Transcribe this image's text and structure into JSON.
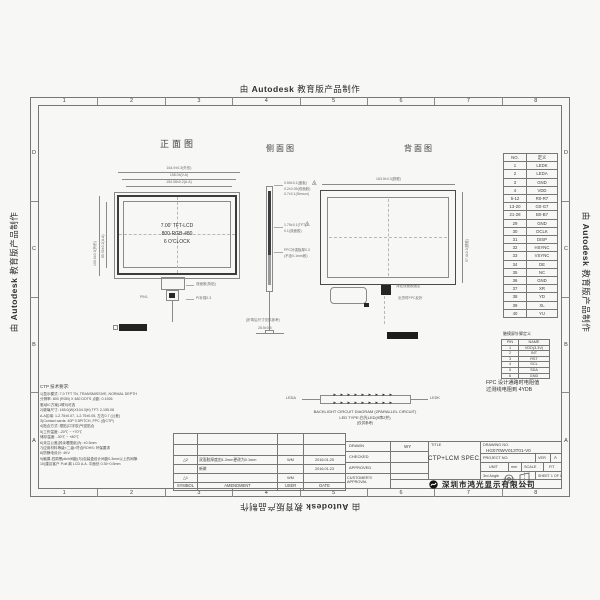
{
  "watermark": {
    "prefix": "由",
    "brand": "Autodesk",
    "suffix": "教育版产品制作"
  },
  "frame": {
    "zone_numbers": [
      "1",
      "2",
      "3",
      "4",
      "5",
      "6",
      "7",
      "8"
    ],
    "zone_letters": [
      "D",
      "C",
      "B",
      "A"
    ]
  },
  "front_view": {
    "title": "正面图",
    "center_line1": "7.00' TFT-LCD",
    "center_line2": "800-RGB-480",
    "center_line3": "6 O'CLOCK",
    "dim_top1": "164.9±0.3(外形)",
    "dim_top2": "158.04(V.A)",
    "dim_top3": "154.08±0.2(A.A)",
    "dim_left1": "100.0±0.3(外形)",
    "dim_left2": "85.92±0.2(A.A)",
    "note_pin": "PIN1",
    "note_right1": "双面胶(背贴)",
    "note_right2": "PI补强0.3"
  },
  "side_view": {
    "title": "侧面图",
    "ann_top1": "0.55±0.1(盖板)",
    "ann_top2": "0.2±0.05(双面胶)",
    "ann_top3": "0.7±0.1(Sensor)",
    "tri_top": "2",
    "ann_mid1": "1.75±0.1(TFT)",
    "ann_mid2": "0.1(双面胶)",
    "tri_mid": "1",
    "ann_low1": "FPC补强板厚0.3",
    "ann_low2": "(不含0.1mm胶)",
    "ann_bottom": "(折弯后尺寸仅供参考)",
    "dim_bottom": "28.5±0.5"
  },
  "back_view": {
    "title": "背面图",
    "dim_top": "163.9±0.3(铁框)",
    "dim_right": "97.4±0.3(铁框)",
    "note1": "背贴双面胶固定",
    "note2": "出货时FPC反折"
  },
  "pin_table": {
    "headers": [
      "NO.",
      "定义"
    ],
    "rows": [
      [
        "1",
        "LEDK"
      ],
      [
        "2",
        "LEDA"
      ],
      [
        "3",
        "GND"
      ],
      [
        "4",
        "VDD"
      ],
      [
        "5-12",
        "R0-R7"
      ],
      [
        "13-20",
        "G0-G7"
      ],
      [
        "21-28",
        "B0-B7"
      ],
      [
        "29",
        "GND"
      ],
      [
        "30",
        "DCLK"
      ],
      [
        "31",
        "DISP"
      ],
      [
        "32",
        "HSYNC"
      ],
      [
        "33",
        "VSYNC"
      ],
      [
        "34",
        "DE"
      ],
      [
        "35",
        "NC"
      ],
      [
        "36",
        "GND"
      ],
      [
        "37",
        "XR"
      ],
      [
        "38",
        "YD"
      ],
      [
        "39",
        "XL"
      ],
      [
        "40",
        "YU"
      ]
    ]
  },
  "ctp_table": {
    "title": "触摸屏针脚定义",
    "headers": [
      "PIN",
      "NAME"
    ],
    "rows": [
      [
        "1",
        "VDD(3.3V)"
      ],
      [
        "2",
        "INT"
      ],
      [
        "3",
        "RST"
      ],
      [
        "4",
        "SCL"
      ],
      [
        "5",
        "SDA"
      ],
      [
        "6",
        "GND"
      ]
    ]
  },
  "fpc_note": {
    "line1": "FPC 设计通路时电阻值",
    "line2": "过测线电阻到 4YDB"
  },
  "backlight": {
    "led_row": "▸▸▸▸▸▸▸▸▸",
    "label_left": "LEDA",
    "label_right": "LEDK",
    "caption1": "BACKLIGHT CIRCUIT DIAGRAM (2PARALLEL CIRCUIT)",
    "caption2": "LED TYPE:白光LED(9串2并)",
    "caption3": "(仅供参考)"
  },
  "notes": {
    "title": "CTP 技术要求:",
    "lines": [
      "1)显示模式: 7.0 TFT TN, TRANSMISSIVE, NORMAL DEPTH",
      "   分辨率: 800 (RGB) X 480 DOTS 点距: 0.1926",
      "   驱动IC方案(1联5)可选",
      "2)玻璃尺寸: 165.0(W)X104.3(H) TFT: 2-155.08",
      "   A.A区域: 1-2.75±0.07, 1-2.75±0.05, 左右0.7 (公差)",
      "3)Contact cards: 40P 0.5PITCH, FPC (含CTP)",
      "4)贴合方式: 框贴(口字胶)气密贴合",
      "5)工作温度: -20℃ ~ +70℃",
      "   储存温度: -30℃ ~ +80℃",
      "6)未注公差(其余看图纸)为: ±0.3mm",
      "7)应用材料等级<二级>符合ROHS: 环保要求",
      "8)防静电设计: 4KV",
      "9)触摸-四周黑pitch间距(与)包装盒设计间距0.3mm以上的间隙.",
      "10)建议客户 P.olt 离 LCD A.A. 平面处 0.35~0.5mm"
    ]
  },
  "revision_table": {
    "headers": [
      "SYMBOL",
      "AMENDMENT",
      "USER",
      "DATE"
    ],
    "rows": [
      {
        "symbol": "△2",
        "text": "双面胶厚度由1.2mm更改为0.1mm",
        "user": "WM",
        "date": "2016.01.25"
      },
      {
        "symbol": "",
        "text": "新做",
        "user": "",
        "date": "2016.01.23"
      },
      {
        "symbol": "△1",
        "text": "",
        "user": "WM",
        "date": ""
      }
    ]
  },
  "title_block": {
    "drawn_label": "DRAWN",
    "drawn_value": "WY",
    "checked_label": "CHECKED",
    "approved_label": "APPROVED",
    "customer_label": "CUSTOMER'S APPROVAL",
    "title_label": "TITLE",
    "title_value": "CTP+LCM SPEC.",
    "drawing_no_label": "DRAWING NO.",
    "drawing_no_value": "HG070WV013T01-V0",
    "project_no_label": "PROJECT NO.",
    "ver_label": "VER",
    "ver_value": "A",
    "unit_label": "UNIT",
    "unit_value": "mm",
    "scale_label": "SCALE",
    "scale_value": "FIT",
    "angle_label": "3rd Angle",
    "sheet_label": "SHEET 1 OF 1",
    "company": "深圳市鸿光显示有限公司"
  },
  "colors": {
    "line": "#8a8a8a",
    "bezel": "#3c3c3c",
    "connector": "#222222",
    "background": "#f7f7f5"
  }
}
